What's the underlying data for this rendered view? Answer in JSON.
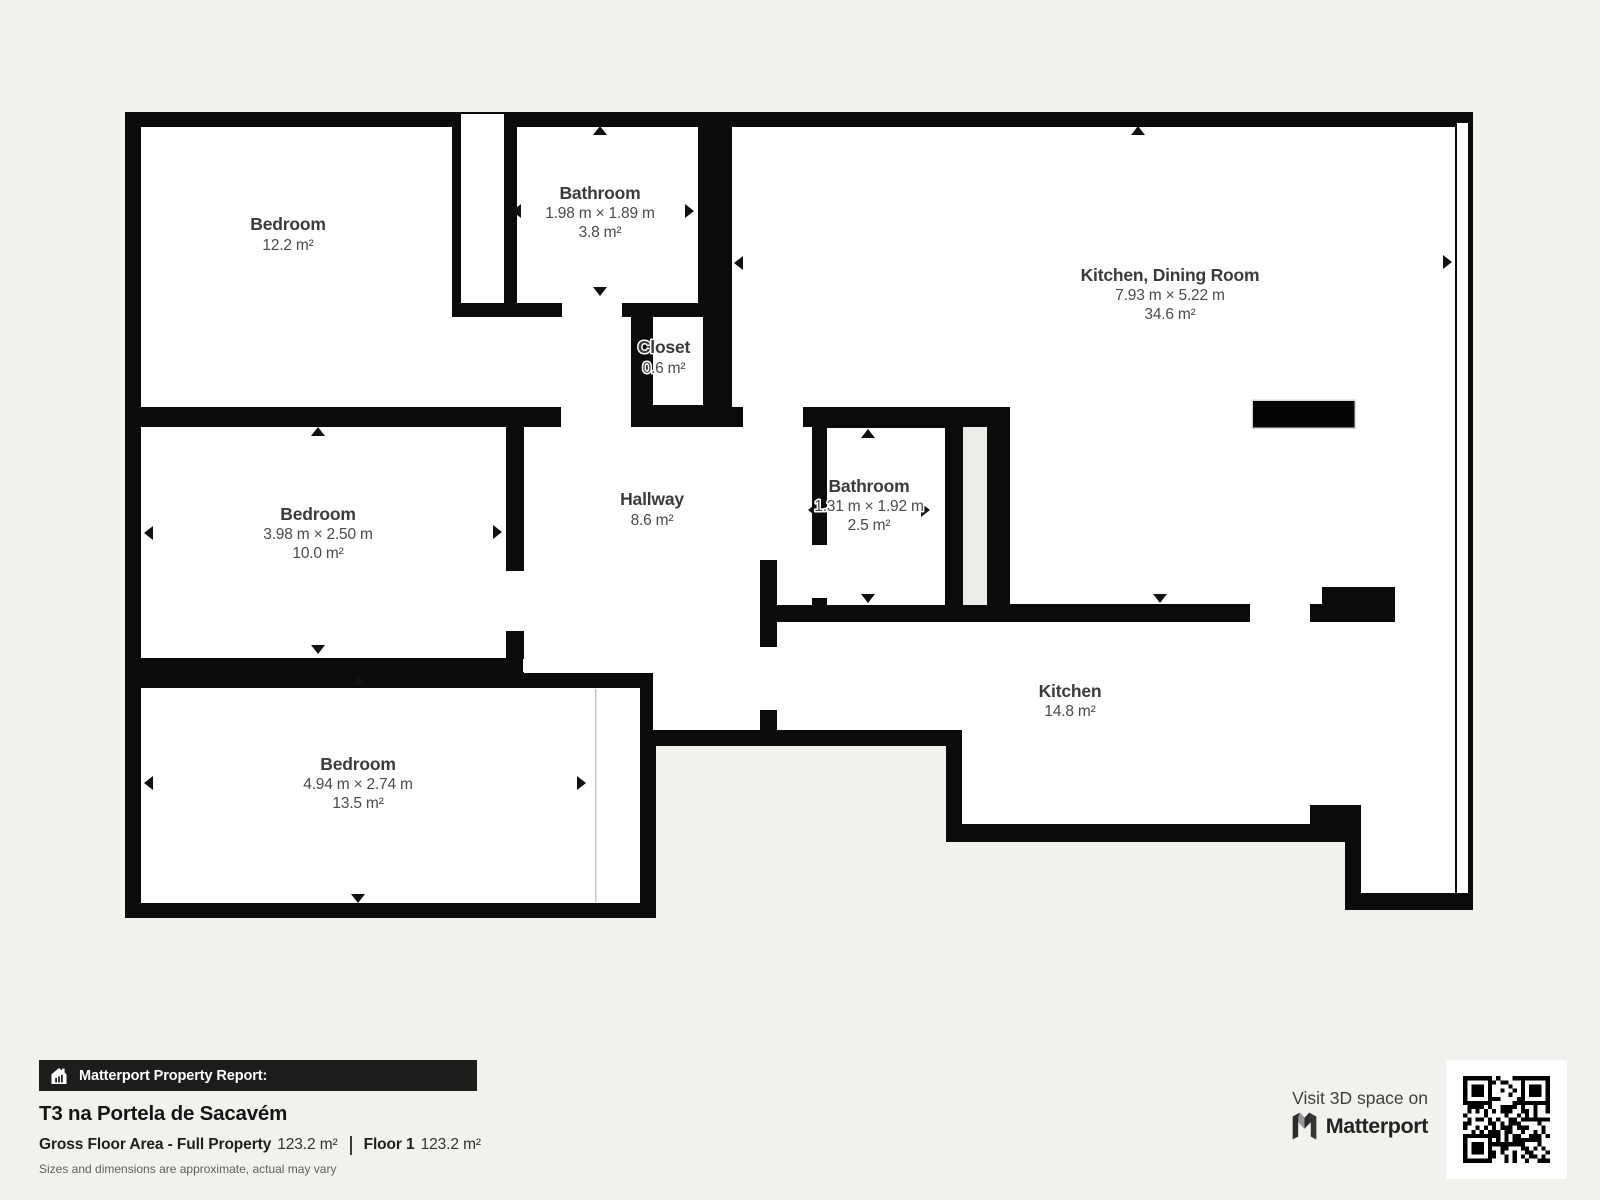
{
  "report_banner": {
    "label": "Matterport Property Report:"
  },
  "property": {
    "title": "T3 na Portela de Sacavém",
    "gross_floor_area_label": "Gross Floor Area - Full Property",
    "gross_floor_area_value": "123.2 m²",
    "floor_label": "Floor 1",
    "floor_value": "123.2 m²",
    "disclaimer": "Sizes and dimensions are approximate, actual may vary"
  },
  "visit_3d": {
    "text": "Visit 3D space on",
    "brand": "Matterport"
  },
  "rooms": [
    {
      "name": "Bedroom",
      "area": "12.2 m²"
    },
    {
      "name": "Bathroom",
      "dimensions": "1.98 m × 1.89 m",
      "area": "3.8 m²"
    },
    {
      "name": "Kitchen, Dining Room",
      "dimensions": "7.93 m × 5.22 m",
      "area": "34.6 m²"
    },
    {
      "name": "Closet",
      "area": "0.6 m²"
    },
    {
      "name": "Bedroom",
      "dimensions": "3.98 m × 2.50 m",
      "area": "10.0 m²"
    },
    {
      "name": "Hallway",
      "area": "8.6 m²"
    },
    {
      "name": "Bathroom",
      "dimensions": "1.31 m × 1.92 m",
      "area": "2.5 m²"
    },
    {
      "name": "Kitchen",
      "area": "14.8 m²"
    },
    {
      "name": "Bedroom",
      "dimensions": "4.94 m × 2.74 m",
      "area": "13.5 m²"
    }
  ],
  "colors": {
    "background": "#f2f1ee",
    "walls": "#0b0b0b",
    "room_fill": "#ffffff",
    "label_text": "#3b3b3b",
    "banner_background": "#1d1d1b",
    "banner_text": "#ffffff"
  }
}
